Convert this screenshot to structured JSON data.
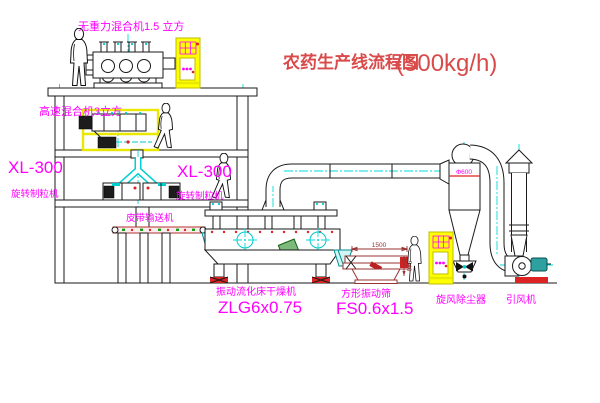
{
  "title": {
    "text": "农药生产线流程图",
    "capacity": "(500kg/h)"
  },
  "labels": {
    "gravity_mixer": "无重力混合机1.5 立方",
    "high_speed_mixer": "高速混合机3立方",
    "granulator_left_model": "XL-300",
    "granulator_left_name": "旋转制粒机",
    "granulator_right_model": "XL-300",
    "granulator_right_name": "旋转制粒机",
    "belt_conveyor": "皮带输送机",
    "dryer_name": "振动流化床干燥机",
    "dryer_model": "ZLG6x0.75",
    "sieve_name": "方形振动筛",
    "sieve_model": "FS0.6x1.5",
    "cyclone_name": "旋风除尘器",
    "cyclone_diameter": "Φ600",
    "fan_name": "引风机"
  },
  "dimensions": {
    "sieve_length": "1500",
    "sieve_height": "540"
  },
  "colors": {
    "label_magenta": "#FF00FF",
    "title_red": "#D94A4A",
    "centerline_cyan": "#00DADA",
    "cabinet_yellow": "#FFFF00",
    "sieve_maroon": "#993333",
    "accent_red": "#DD2222",
    "motor_teal": "#2FA0A0",
    "line_black": "#1A1A1A",
    "background": "#FFFFFF"
  }
}
